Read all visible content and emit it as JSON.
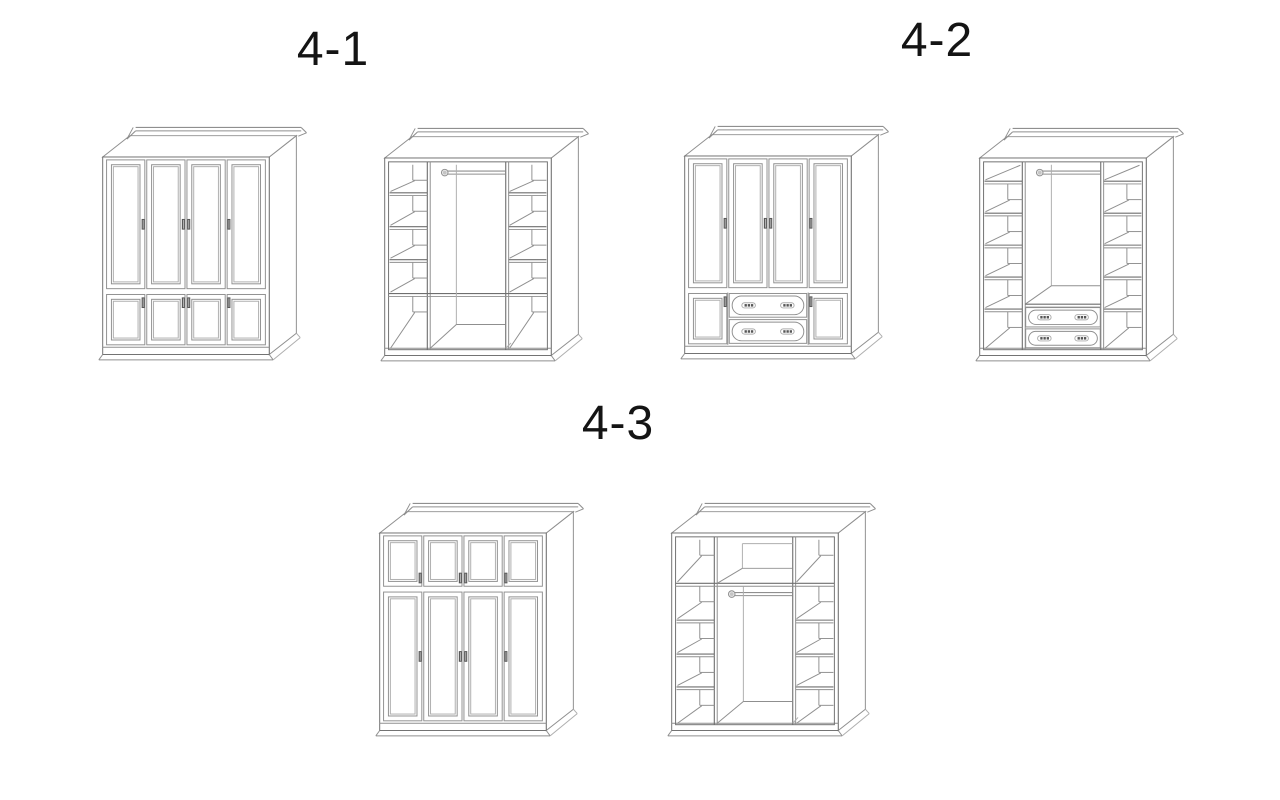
{
  "page": {
    "background": "#ffffff"
  },
  "palette": {
    "line": "#8f8f8f",
    "dark": "#6f6f6f",
    "soft": "#aeaeae",
    "handle": "#565656",
    "handle_light": "#cfcfcf",
    "cap_fill": "#e8e8e8",
    "fill": "#ffffff",
    "label_color": "#141414"
  },
  "figures": [
    {
      "label": "4-1",
      "drawings": [
        {
          "name": "wardrobe-4-1-front",
          "view": "front",
          "rows": [
            {
              "type": "doors",
              "size": "tall",
              "handles": "middle"
            },
            {
              "type": "doors",
              "size": "short",
              "handles": "top"
            }
          ]
        },
        {
          "name": "wardrobe-4-1-interior",
          "view": "interior",
          "rod_y": 45.5,
          "side_shelves": [
            68,
            103,
            137
          ],
          "full_shelf_y": 172,
          "top_band": false,
          "bottom": "open"
        }
      ]
    },
    {
      "label": "4-2",
      "drawings": [
        {
          "name": "wardrobe-4-2-front",
          "view": "front",
          "rows": [
            {
              "type": "doors",
              "size": "tall",
              "handles": "middle"
            },
            {
              "type": "mixed",
              "size": "short"
            }
          ]
        },
        {
          "name": "wardrobe-4-2-interior",
          "view": "interior",
          "rod_y": 45.5,
          "side_shelves": [
            56,
            89,
            122,
            155,
            188
          ],
          "full_shelf_y": null,
          "top_band": false,
          "bottom": "drawers"
        }
      ]
    },
    {
      "label": "4-3",
      "drawings": [
        {
          "name": "wardrobe-4-3-front",
          "view": "front",
          "rows": [
            {
              "type": "doors",
              "size": "short",
              "handles": "bottom"
            },
            {
              "type": "doors",
              "size": "tall",
              "handles": "middle"
            }
          ]
        },
        {
          "name": "wardrobe-4-3-interior",
          "view": "interior",
          "rod_y": 93.5,
          "side_shelves": [
            122,
            157,
            191
          ],
          "full_shelf_y": 84,
          "top_band": true,
          "bottom": "open-deep"
        }
      ]
    }
  ]
}
